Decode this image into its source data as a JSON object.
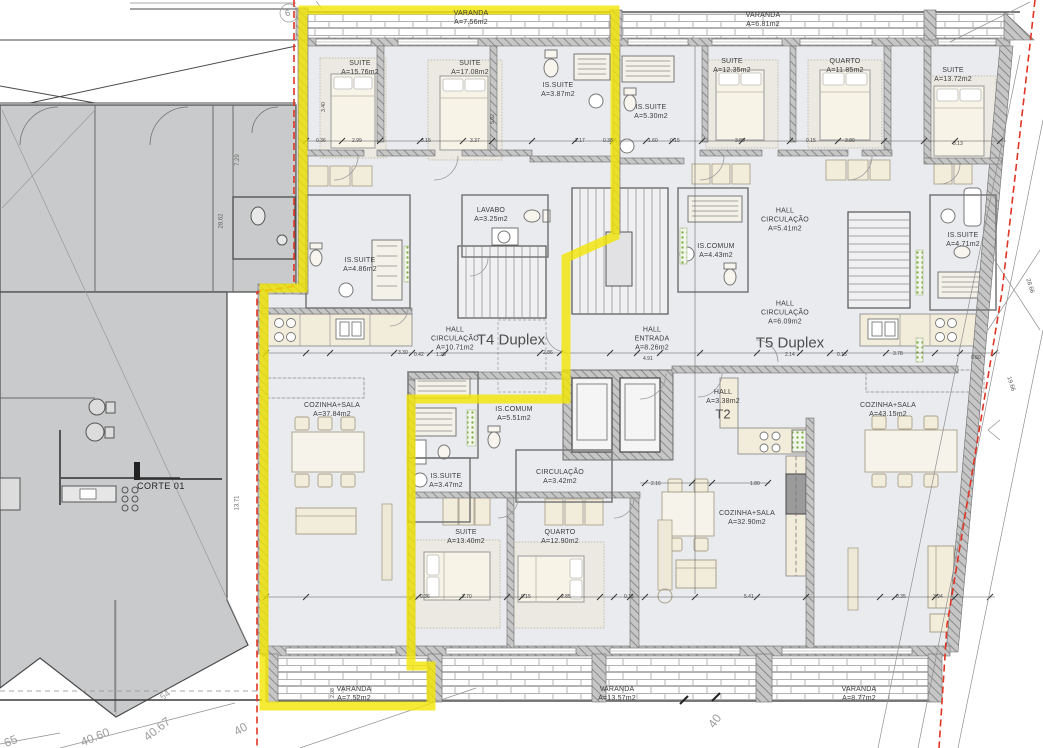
{
  "section": {
    "label": "CORTE 01"
  },
  "units": [
    {
      "label": "T4 Duplex",
      "x": 511,
      "y": 340,
      "size": 15
    },
    {
      "label": "T5 Duplex",
      "x": 790,
      "y": 343,
      "size": 15
    },
    {
      "label": "T2",
      "x": 723,
      "y": 414,
      "size": 13
    }
  ],
  "rooms": [
    {
      "name": "VARANDA",
      "area": "A=7.56m2",
      "x": 471,
      "y": 18
    },
    {
      "name": "VARANDA",
      "area": "A=6.81m2",
      "x": 763,
      "y": 20
    },
    {
      "name": "SUITE",
      "area": "A=15.76m2",
      "x": 360,
      "y": 68
    },
    {
      "name": "SUITE",
      "area": "A=17.08m2",
      "x": 470,
      "y": 68
    },
    {
      "name": "IS.SUITE",
      "area": "A=3.87m2",
      "x": 558,
      "y": 90
    },
    {
      "name": "IS.SUITE",
      "area": "A=5.30m2",
      "x": 651,
      "y": 112
    },
    {
      "name": "SUITE",
      "area": "A=12.35m2",
      "x": 732,
      "y": 66
    },
    {
      "name": "QUARTO",
      "area": "A=11.85m2",
      "x": 845,
      "y": 66
    },
    {
      "name": "SUITE",
      "area": "A=13.72m2",
      "x": 953,
      "y": 75
    },
    {
      "name": "LAVABO",
      "area": "A=3.25m2",
      "x": 491,
      "y": 215
    },
    {
      "name": "IS.SUITE",
      "area": "A=4.86m2",
      "x": 360,
      "y": 265
    },
    {
      "name": "HALL\nCIRCULAÇÃO",
      "area": "A=10.71m2",
      "x": 455,
      "y": 339
    },
    {
      "name": "HALL\nCIRCULAÇÃO",
      "area": "A=5.41m2",
      "x": 785,
      "y": 220
    },
    {
      "name": "IS.COMUM",
      "area": "A=4.43m2",
      "x": 716,
      "y": 251
    },
    {
      "name": "HALL\nCIRCULAÇÃO",
      "area": "A=6.09m2",
      "x": 785,
      "y": 313
    },
    {
      "name": "HALL\nENTRADA",
      "area": "A=8.26m2",
      "x": 652,
      "y": 339
    },
    {
      "name": "IS.SUITE",
      "area": "A=4.71m2",
      "x": 963,
      "y": 240
    },
    {
      "name": "HALL",
      "area": "A=3.38m2",
      "x": 723,
      "y": 397
    },
    {
      "name": "COZINHA+SALA",
      "area": "A=43.15m2",
      "x": 888,
      "y": 410
    },
    {
      "name": "COZINHA+SALA",
      "area": "A=37.84m2",
      "x": 332,
      "y": 410
    },
    {
      "name": "IS.COMUM",
      "area": "A=5.51m2",
      "x": 514,
      "y": 414
    },
    {
      "name": "IS.SUITE",
      "area": "A=3.47m2",
      "x": 446,
      "y": 481
    },
    {
      "name": "CIRCULAÇÃO",
      "area": "A=3.42m2",
      "x": 560,
      "y": 477
    },
    {
      "name": "SUITE",
      "area": "A=13.40m2",
      "x": 466,
      "y": 537
    },
    {
      "name": "QUARTO",
      "area": "A=12.90m2",
      "x": 560,
      "y": 537
    },
    {
      "name": "COZINHA+SALA",
      "area": "A=32.90m2",
      "x": 747,
      "y": 518
    },
    {
      "name": "VARANDA",
      "area": "A=7.52m2",
      "x": 354,
      "y": 694
    },
    {
      "name": "VARANDA",
      "area": "A=13.57m2",
      "x": 617,
      "y": 694
    },
    {
      "name": "VARANDA",
      "area": "A=8.77m2",
      "x": 859,
      "y": 694
    }
  ],
  "annotations": [
    {
      "t": "0.36",
      "x": 316,
      "y": 138,
      "r": 0,
      "s": 5,
      "c": "#444"
    },
    {
      "t": "2.99",
      "x": 352,
      "y": 138,
      "r": 0,
      "s": 5,
      "c": "#444"
    },
    {
      "t": "3.15",
      "x": 421,
      "y": 138,
      "r": 0,
      "s": 5,
      "c": "#444"
    },
    {
      "t": "3.37",
      "x": 470,
      "y": 138,
      "r": 0,
      "s": 5,
      "c": "#444"
    },
    {
      "t": "2.17",
      "x": 575,
      "y": 138,
      "r": 0,
      "s": 5,
      "c": "#444"
    },
    {
      "t": "0.38",
      "x": 603,
      "y": 138,
      "r": 0,
      "s": 5,
      "c": "#444"
    },
    {
      "t": "1.60",
      "x": 648,
      "y": 138,
      "r": 0,
      "s": 5,
      "c": "#444"
    },
    {
      "t": "0.15",
      "x": 670,
      "y": 138,
      "r": 0,
      "s": 5,
      "c": "#444"
    },
    {
      "t": "3.80",
      "x": 735,
      "y": 138,
      "r": 0,
      "s": 5,
      "c": "#444"
    },
    {
      "t": "0.15",
      "x": 806,
      "y": 138,
      "r": 0,
      "s": 5,
      "c": "#444"
    },
    {
      "t": "3.80",
      "x": 845,
      "y": 138,
      "r": 0,
      "s": 5,
      "c": "#444"
    },
    {
      "t": "3.13",
      "x": 953,
      "y": 141,
      "r": 0,
      "s": 5,
      "c": "#444"
    },
    {
      "t": "3.30",
      "x": 398,
      "y": 350,
      "r": 0,
      "s": 5,
      "c": "#444"
    },
    {
      "t": "0.42",
      "x": 414,
      "y": 352,
      "r": 0,
      "s": 5,
      "c": "#444"
    },
    {
      "t": "1.20",
      "x": 436,
      "y": 352,
      "r": 0,
      "s": 5,
      "c": "#444"
    },
    {
      "t": "2.86",
      "x": 543,
      "y": 350,
      "r": 0,
      "s": 5,
      "c": "#444"
    },
    {
      "t": "4.91",
      "x": 643,
      "y": 356,
      "r": 0,
      "s": 5,
      "c": "#444"
    },
    {
      "t": "2.14",
      "x": 785,
      "y": 352,
      "r": 0,
      "s": 5,
      "c": "#444"
    },
    {
      "t": "0.15",
      "x": 837,
      "y": 352,
      "r": 0,
      "s": 5,
      "c": "#444"
    },
    {
      "t": "3.78",
      "x": 893,
      "y": 351,
      "r": 0,
      "s": 5,
      "c": "#444"
    },
    {
      "t": "0.60",
      "x": 971,
      "y": 355,
      "r": 0,
      "s": 5,
      "c": "#444"
    },
    {
      "t": "0.36",
      "x": 420,
      "y": 594,
      "r": 0,
      "s": 5,
      "c": "#444"
    },
    {
      "t": "2.70",
      "x": 462,
      "y": 594,
      "r": 0,
      "s": 5,
      "c": "#444"
    },
    {
      "t": "0.15",
      "x": 521,
      "y": 594,
      "r": 0,
      "s": 5,
      "c": "#444"
    },
    {
      "t": "2.85",
      "x": 561,
      "y": 594,
      "r": 0,
      "s": 5,
      "c": "#444"
    },
    {
      "t": "0.15",
      "x": 624,
      "y": 594,
      "r": 0,
      "s": 5,
      "c": "#444"
    },
    {
      "t": "5.41",
      "x": 744,
      "y": 594,
      "r": 0,
      "s": 5,
      "c": "#444"
    },
    {
      "t": "0.35",
      "x": 896,
      "y": 594,
      "r": 0,
      "s": 5,
      "c": "#444"
    },
    {
      "t": "3.94",
      "x": 933,
      "y": 594,
      "r": 0,
      "s": 5,
      "c": "#444"
    },
    {
      "t": "2.16",
      "x": 651,
      "y": 481,
      "r": 0,
      "s": 5,
      "c": "#444"
    },
    {
      "t": "1.80",
      "x": 750,
      "y": 481,
      "r": 0,
      "s": 5,
      "c": "#444"
    },
    {
      "t": "3.40",
      "x": 319,
      "y": 104,
      "r": -90,
      "s": 5,
      "c": "#444"
    },
    {
      "t": "5.02",
      "x": 488,
      "y": 116,
      "r": -90,
      "s": 5,
      "c": "#444"
    },
    {
      "t": "2.08",
      "x": 328,
      "y": 690,
      "r": -90,
      "s": 5,
      "c": "#444"
    },
    {
      "t": "13.71",
      "x": 230,
      "y": 500,
      "r": -90,
      "s": 6,
      "c": "#666"
    },
    {
      "t": "7.29",
      "x": 232,
      "y": 157,
      "r": -90,
      "s": 6,
      "c": "#666"
    },
    {
      "t": "28.62",
      "x": 214,
      "y": 218,
      "r": -90,
      "s": 6,
      "c": "#666"
    },
    {
      "t": "28.66",
      "x": 1022,
      "y": 283,
      "r": 72,
      "s": 6,
      "c": "#555"
    },
    {
      "t": "19.66",
      "x": 1003,
      "y": 381,
      "r": 72,
      "s": 6,
      "c": "#555"
    },
    {
      "t": "54",
      "x": 160,
      "y": 690,
      "r": -38,
      "s": 9,
      "c": "#9c9c9c"
    },
    {
      "t": "40.67",
      "x": 142,
      "y": 722,
      "r": -38,
      "s": 12,
      "c": "#9c9c9c"
    },
    {
      "t": "40.60",
      "x": 80,
      "y": 730,
      "r": -22,
      "s": 12,
      "c": "#9c9c9c"
    },
    {
      "t": "40",
      "x": 234,
      "y": 722,
      "r": -30,
      "s": 12,
      "c": "#9c9c9c"
    },
    {
      "t": "65",
      "x": 4,
      "y": 734,
      "r": -22,
      "s": 12,
      "c": "#9c9c9c"
    },
    {
      "t": "40",
      "x": 708,
      "y": 714,
      "r": -55,
      "s": 12,
      "c": "#9c9c9c"
    },
    {
      "t": "6",
      "x": 285,
      "y": 8,
      "r": -15,
      "s": 9,
      "c": "#888"
    }
  ],
  "colors": {
    "highlight_yellow": "#f2e602",
    "boundary_red": "#e03424",
    "wall_gray": "#c6c6c6",
    "floor": "#e9ebee",
    "neighbor_gray": "#c9cacb",
    "furniture_beige": "#f2ecdb",
    "green_fitting": "#86b24a"
  }
}
